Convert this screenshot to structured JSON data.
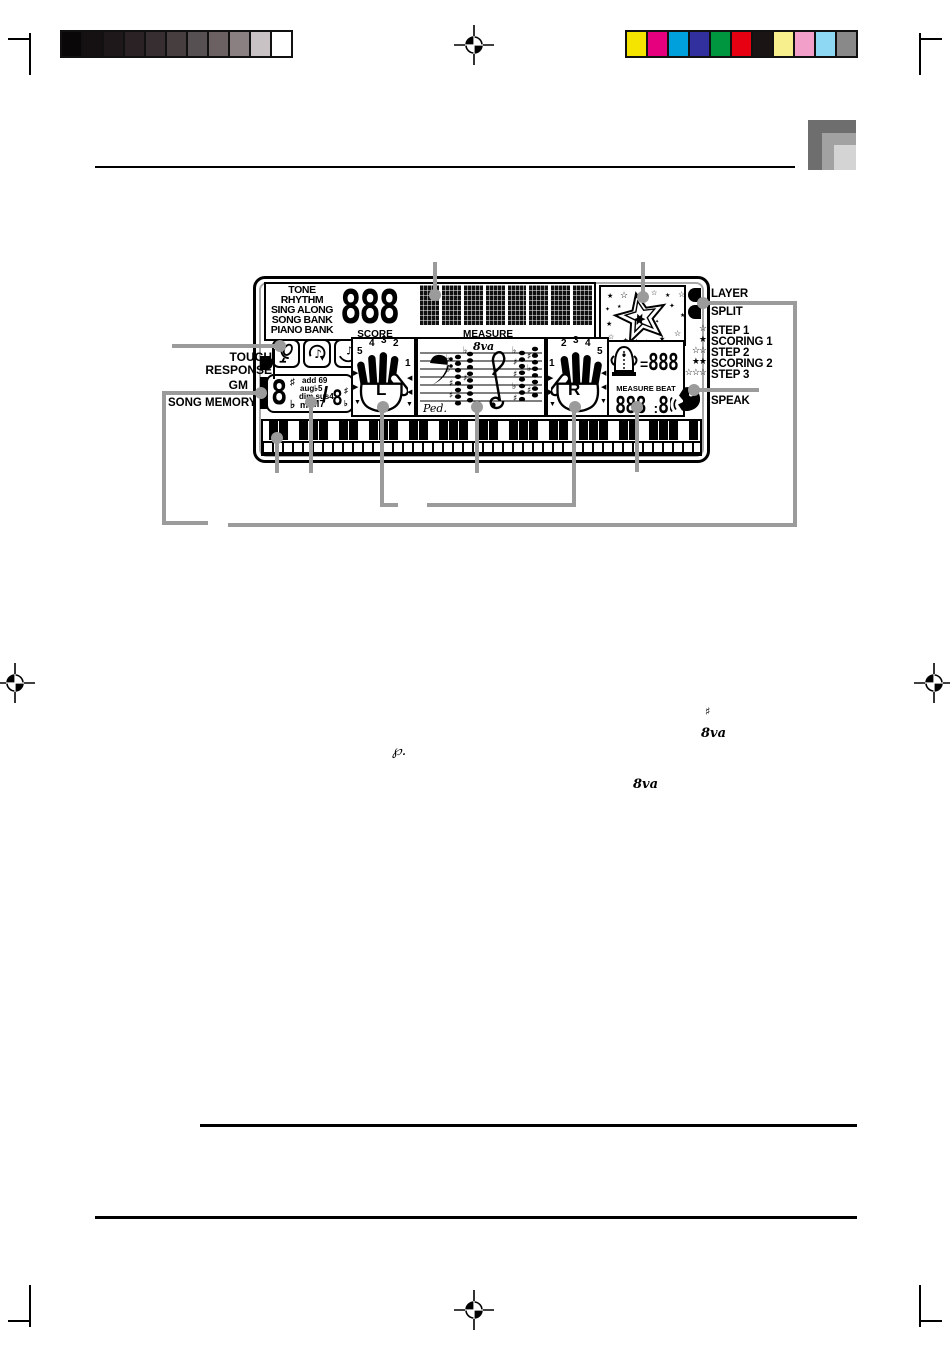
{
  "calibration": {
    "grayscale_swatches": [
      "#0a0708",
      "#151012",
      "#1f181a",
      "#2a2224",
      "#362e30",
      "#473e40",
      "#575052",
      "#6b6163",
      "#8a8082",
      "#c9c2c4",
      "#ffffff"
    ],
    "color_swatches": [
      "#f5e400",
      "#e6007d",
      "#00a0dd",
      "#32309f",
      "#00963f",
      "#e60012",
      "#1a1415",
      "#f7ef8e",
      "#f2a0c9",
      "#8fd8f4",
      "#898989"
    ]
  },
  "lcd": {
    "mode_labels": [
      "TONE",
      "RHYTHM",
      "SING ALONG",
      "SONG BANK",
      "PIANO BANK"
    ],
    "main_digits": "888",
    "score_label": "SCORE",
    "measure_label": "MEASURE",
    "chord": {
      "root_digit": "8",
      "sharp": "♯",
      "flat": "♭",
      "mod1": "add 69",
      "mod2": "aug♭5",
      "mod3": "dim sus4",
      "mod4": "m",
      "mod5": "M7",
      "slash": "/",
      "bass_digit": "8",
      "bass_sharp": "♯",
      "bass_flat": "♭"
    },
    "left_hand": {
      "label": "L",
      "fingers": [
        "5",
        "4",
        "3",
        "2",
        "1"
      ]
    },
    "right_hand": {
      "label": "R",
      "fingers": [
        "1",
        "2",
        "3",
        "4",
        "5"
      ]
    },
    "staff": {
      "octave_label": "8va",
      "pedal_label": "Ped."
    },
    "tempo": {
      "equals": "=",
      "digits": "888"
    },
    "measure_beat": {
      "label": "MEASURE BEAT",
      "digits": "888",
      "colon": ":",
      "beat": "8"
    },
    "scoring_stars": [
      "☆",
      "★",
      "☆☆",
      "★★",
      "☆☆☆"
    ]
  },
  "left_labels": {
    "touch_response_line1": "TOUCH",
    "touch_response_line2": "RESPONSE",
    "gm": "GM",
    "song_memory": "SONG MEMORY"
  },
  "right_labels": {
    "layer": "LAYER",
    "split": "SPLIT",
    "step1": "STEP 1",
    "scoring1": "SCORING 1",
    "step2": "STEP 2",
    "scoring2": "SCORING 2",
    "step3": "STEP 3",
    "speak": "SPEAK"
  },
  "floating_glyphs": {
    "sharp": "♯",
    "octave_upper": "8va",
    "pedal": "℘.",
    "octave_lower": "8va"
  },
  "icons": {
    "microphone": "microphone-icon",
    "sing_along": "sing-along-note-icon",
    "note_hand": "note-hand-icon",
    "metronome": "metronome-character-icon",
    "speak_face": "speak-face-icon",
    "star_burst": "star-burst-icon",
    "registration": "registration-crosshair-icon"
  },
  "colors": {
    "callout": "#9b9b9b"
  }
}
